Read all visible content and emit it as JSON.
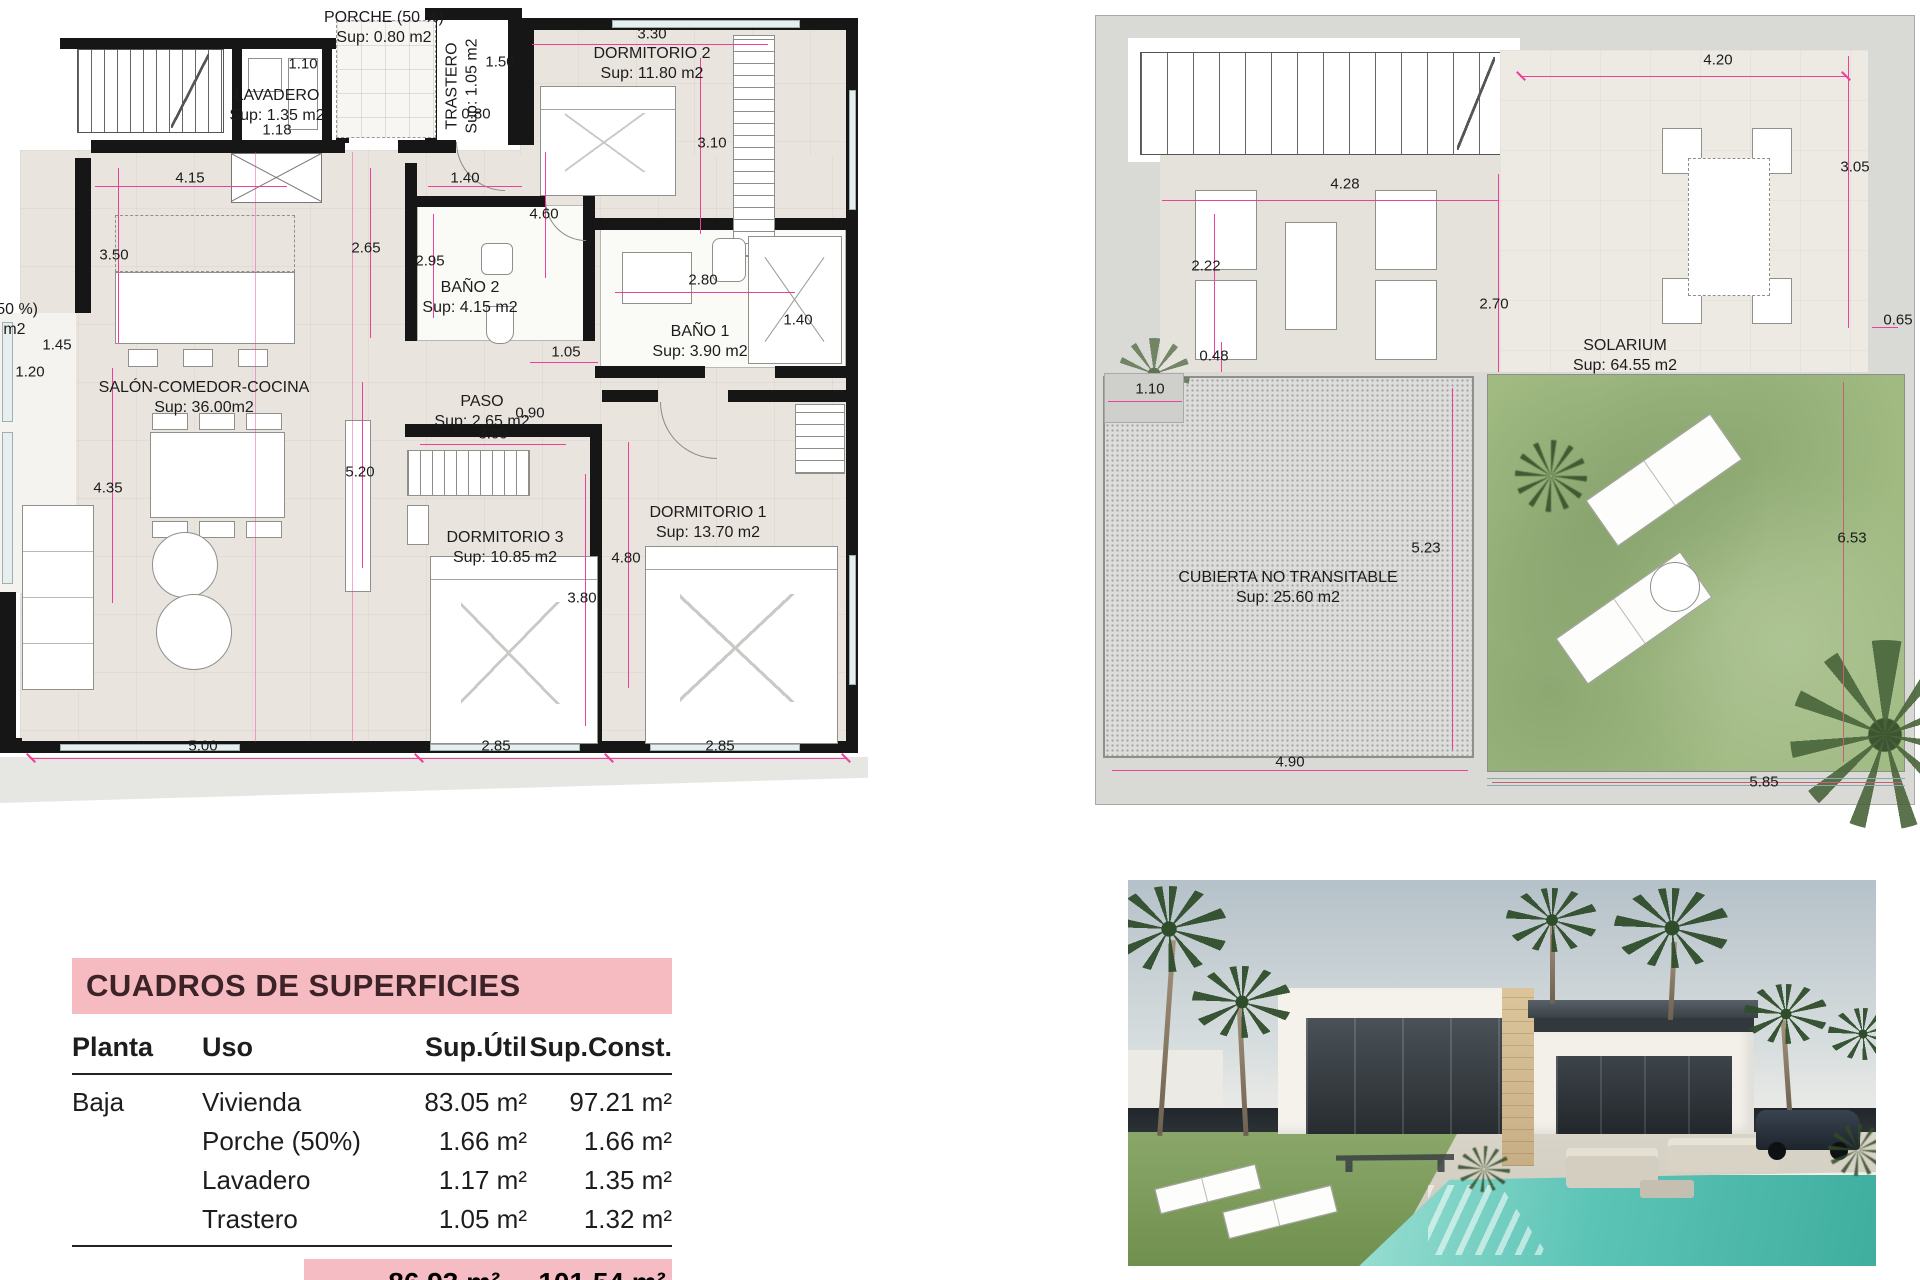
{
  "ground_floor_plan": {
    "room_labels": [
      {
        "lines": [
          "PORCHE (50 %)",
          "Sup: 0.80 m2"
        ],
        "x": 384,
        "y": 8
      },
      {
        "lines": [
          "LAVADERO",
          "Sup: 1.35 m2"
        ],
        "x": 277,
        "y": 86
      },
      {
        "lines": [
          "TRASTERO",
          "Sup: 1.05 m2"
        ],
        "x": 462,
        "y": 86,
        "rot": 1
      },
      {
        "lines": [
          "DORMITORIO 2",
          "Sup: 11.80 m2"
        ],
        "x": 652,
        "y": 44
      },
      {
        "lines": [
          "BAÑO 2",
          "Sup: 4.15 m2"
        ],
        "x": 470,
        "y": 278
      },
      {
        "lines": [
          "BAÑO 1",
          "Sup: 3.90 m2"
        ],
        "x": 700,
        "y": 322
      },
      {
        "lines": [
          "SALÓN-COMEDOR-COCINA",
          "Sup: 36.00m2"
        ],
        "x": 204,
        "y": 378
      },
      {
        "lines": [
          "PASO",
          "Sup: 2.65 m2"
        ],
        "x": 482,
        "y": 392
      },
      {
        "lines": [
          "DORMITORIO 3",
          "Sup: 10.85 m2"
        ],
        "x": 505,
        "y": 528
      },
      {
        "lines": [
          "DORMITORIO 1",
          "Sup: 13.70 m2"
        ],
        "x": 708,
        "y": 503
      },
      {
        "lines": [
          "PORCHE (50 %)",
          "Sup: 0.86 m2"
        ],
        "x": -22,
        "y": 300
      }
    ],
    "dim_labels": [
      {
        "text": "1.10",
        "x": 303,
        "y": 64
      },
      {
        "text": "1.18",
        "x": 277,
        "y": 130
      },
      {
        "text": "1.50",
        "x": 500,
        "y": 62
      },
      {
        "text": "0.80",
        "x": 476,
        "y": 114
      },
      {
        "text": "3.30",
        "x": 652,
        "y": 34
      },
      {
        "text": "3.10",
        "x": 712,
        "y": 143
      },
      {
        "text": "4.15",
        "x": 190,
        "y": 178
      },
      {
        "text": "1.40",
        "x": 465,
        "y": 178
      },
      {
        "text": "4.60",
        "x": 544,
        "y": 214
      },
      {
        "text": "2.65",
        "x": 366,
        "y": 248
      },
      {
        "text": "2.95",
        "x": 430,
        "y": 261
      },
      {
        "text": "3.50",
        "x": 114,
        "y": 255
      },
      {
        "text": "2.80",
        "x": 703,
        "y": 280
      },
      {
        "text": "1.40",
        "x": 798,
        "y": 320
      },
      {
        "text": "1.45",
        "x": 57,
        "y": 345
      },
      {
        "text": "1.20",
        "x": 30,
        "y": 372
      },
      {
        "text": "1.05",
        "x": 566,
        "y": 352
      },
      {
        "text": "0.90",
        "x": 530,
        "y": 413
      },
      {
        "text": "3.00",
        "x": 493,
        "y": 434
      },
      {
        "text": "5.20",
        "x": 360,
        "y": 472
      },
      {
        "text": "4.35",
        "x": 108,
        "y": 488
      },
      {
        "text": "4.80",
        "x": 626,
        "y": 558
      },
      {
        "text": "3.80",
        "x": 582,
        "y": 598
      },
      {
        "text": "5.00",
        "x": 203,
        "y": 746
      },
      {
        "text": "2.85",
        "x": 496,
        "y": 746
      },
      {
        "text": "2.85",
        "x": 720,
        "y": 746
      }
    ]
  },
  "roof_plan": {
    "room_labels": [
      {
        "lines": [
          "SOLARIUM",
          "Sup: 64.55 m2"
        ],
        "x": 1625,
        "y": 336
      },
      {
        "lines": [
          "CUBIERTA NO TRANSITABLE",
          "Sup: 25.60 m2"
        ],
        "x": 1288,
        "y": 568
      }
    ],
    "dim_labels": [
      {
        "text": "4.20",
        "x": 1718,
        "y": 60
      },
      {
        "text": "3.05",
        "x": 1855,
        "y": 167
      },
      {
        "text": "4.28",
        "x": 1345,
        "y": 184
      },
      {
        "text": "2.22",
        "x": 1206,
        "y": 266
      },
      {
        "text": "2.70",
        "x": 1494,
        "y": 304
      },
      {
        "text": "0.48",
        "x": 1214,
        "y": 356
      },
      {
        "text": "1.10",
        "x": 1150,
        "y": 389
      },
      {
        "text": "0.65",
        "x": 1898,
        "y": 320
      },
      {
        "text": "5.23",
        "x": 1426,
        "y": 548
      },
      {
        "text": "6.53",
        "x": 1852,
        "y": 538
      },
      {
        "text": "4.90",
        "x": 1290,
        "y": 762
      },
      {
        "text": "5.85",
        "x": 1764,
        "y": 782
      }
    ]
  },
  "surface_table": {
    "title": "CUADROS DE SUPERFICIES",
    "columns": [
      "Planta",
      "Uso",
      "Sup.Útil",
      "Sup.Const."
    ],
    "rows": [
      {
        "planta": "Baja",
        "uso": "Vivienda",
        "util": "83.05 m²",
        "const": "97.21 m²"
      },
      {
        "planta": "",
        "uso": "Porche (50%)",
        "util": "1.66 m²",
        "const": "1.66 m²"
      },
      {
        "planta": "",
        "uso": "Lavadero",
        "util": "1.17 m²",
        "const": "1.35 m²"
      },
      {
        "planta": "",
        "uso": "Trastero",
        "util": "1.05 m²",
        "const": "1.32 m²"
      }
    ],
    "total_util": "86.93 m²",
    "total_const": "101.54 m²"
  },
  "colors": {
    "dimension_pink": "#ee3f9b",
    "wall_black": "#161616",
    "table_band_pink": "#f6bac1",
    "grass_green": "#a0ba82",
    "pool_turquoise": "#63c9bd"
  }
}
